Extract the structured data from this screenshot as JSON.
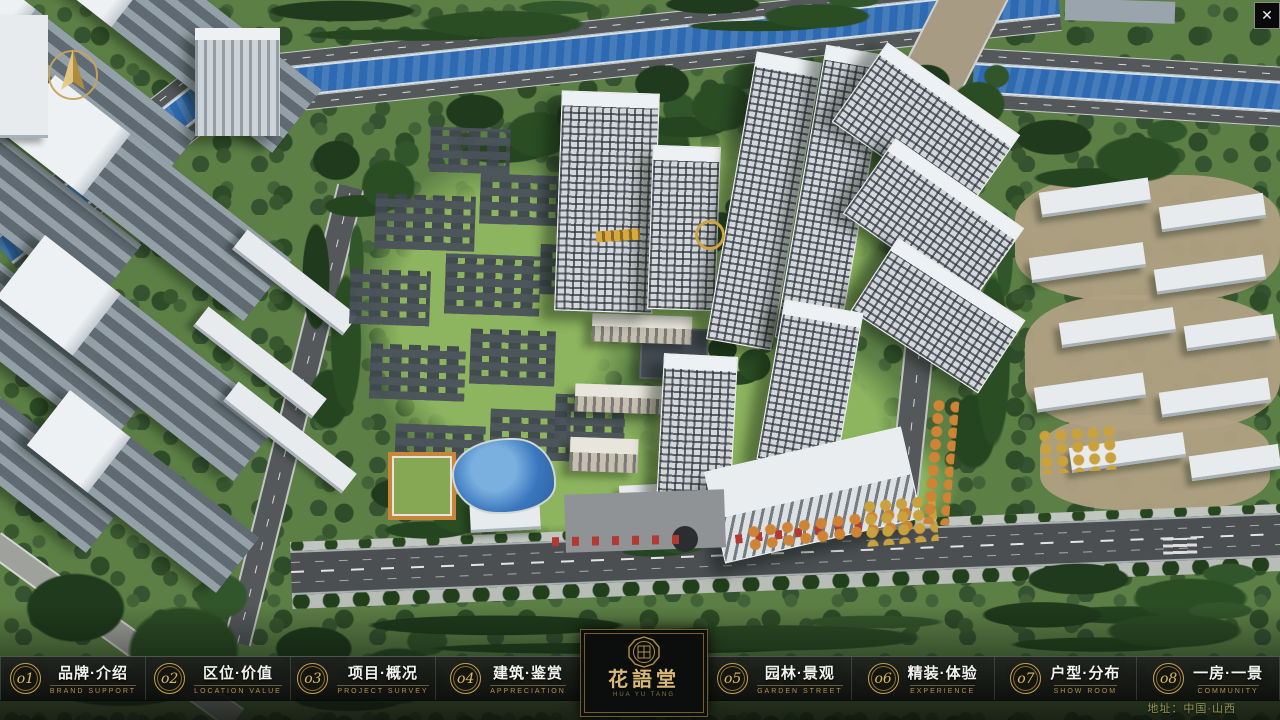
{
  "nav": {
    "items": [
      {
        "num": "o1",
        "zh": "品牌·介绍",
        "en": "BRAND SUPPORT"
      },
      {
        "num": "o2",
        "zh": "区位·价值",
        "en": "LOCATION VALUE"
      },
      {
        "num": "o3",
        "zh": "项目·概况",
        "en": "PROJECT SURVEY"
      },
      {
        "num": "o4",
        "zh": "建筑·鉴赏",
        "en": "APPRECIATION"
      },
      {
        "num": "o5",
        "zh": "园林·景观",
        "en": "GARDEN STREET"
      },
      {
        "num": "o6",
        "zh": "精装·体验",
        "en": "EXPERIENCE"
      },
      {
        "num": "o7",
        "zh": "户型·分布",
        "en": "SHOW ROOM"
      },
      {
        "num": "o8",
        "zh": "一房·一景",
        "en": "COMMUNITY"
      }
    ]
  },
  "logo": {
    "title": "花語堂",
    "subtitle": "HUA YU TANG"
  },
  "footer": {
    "address": "地址：中国·山西"
  },
  "window": {
    "close_glyph": "✕"
  },
  "icons": {
    "compass": "north-arrow",
    "seal": "brand-seal",
    "close": "close-x"
  },
  "colors": {
    "gold": "#c7a353",
    "bar_bg": "#101210",
    "nav_text": "#f2f2ee",
    "nav_en": "#b3924d",
    "river": "#2e6ab1",
    "map_green": "#5b7f45"
  }
}
